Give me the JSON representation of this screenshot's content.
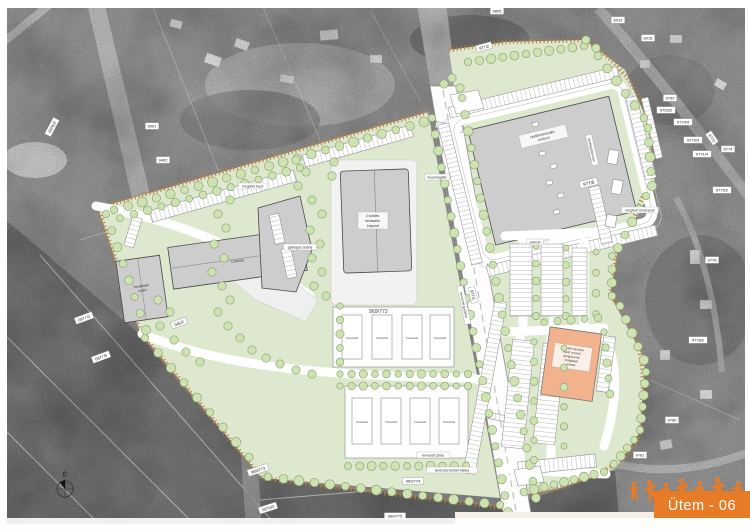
{
  "colors": {
    "brand_orange": "#e87c26",
    "plan_green": "#dde8cf",
    "building_gray": "#cdcdcd",
    "future_orange": "#f2b28e",
    "boundary_tan": "#bf7f3f"
  },
  "banner": {
    "phase_label": "Ütem - 06"
  },
  "compass": {
    "north_label": "É"
  },
  "site": {
    "parcel_main": "969/772",
    "multifunction": {
      "lines": [
        "Multifunkcionális",
        "centrum"
      ],
      "parcel": "977/8"
    },
    "retail": {
      "lines": [
        "2 szintes",
        "bevásárló",
        "központ"
      ]
    },
    "services": {
      "lines": [
        "Szolgáltató",
        "épület"
      ]
    },
    "strip_building": {
      "label": "Üzletsor"
    },
    "future": {
      "lines": [
        "Második ütemben",
        "épülő rendelő,",
        "gyógyszertár,",
        "szolgáltató",
        "üzletek"
      ]
    },
    "rowhouse_label": "Társasház"
  },
  "parcel_labels": [
    {
      "t": "6001",
      "x": 152,
      "y": 126,
      "r": 0
    },
    {
      "t": "9402",
      "x": 163,
      "y": 160,
      "r": 0
    },
    {
      "t": "0976/2",
      "x": 52,
      "y": 127,
      "r": -62
    },
    {
      "t": "0977/2",
      "x": 84,
      "y": 318,
      "r": -20
    },
    {
      "t": "0977/5",
      "x": 101,
      "y": 357,
      "r": -20
    },
    {
      "t": "049/2",
      "x": 179,
      "y": 323,
      "r": -20
    },
    {
      "t": "969/773",
      "x": 258,
      "y": 470,
      "r": -18
    },
    {
      "t": "0979/3",
      "x": 268,
      "y": 508,
      "r": -18
    },
    {
      "t": "969/774",
      "x": 413,
      "y": 481,
      "r": 0
    },
    {
      "t": "969/775",
      "x": 395,
      "y": 516,
      "r": 0
    },
    {
      "t": "9805",
      "x": 497,
      "y": 11,
      "r": 0
    },
    {
      "t": "977/2",
      "x": 484,
      "y": 47,
      "r": -15
    },
    {
      "t": "977/1",
      "x": 473,
      "y": 295,
      "r": 76
    },
    {
      "t": "9762",
      "x": 670,
      "y": 98,
      "r": 0
    },
    {
      "t": "9763/2",
      "x": 666,
      "y": 110,
      "r": 0
    },
    {
      "t": "9770/4",
      "x": 683,
      "y": 122,
      "r": 0
    },
    {
      "t": "9770/3",
      "x": 693,
      "y": 140,
      "r": 0
    },
    {
      "t": "9771/4",
      "x": 702,
      "y": 154,
      "r": 0
    },
    {
      "t": "9774",
      "x": 728,
      "y": 149,
      "r": 0
    },
    {
      "t": "9775/2",
      "x": 722,
      "y": 190,
      "r": 0
    },
    {
      "t": "9772",
      "x": 712,
      "y": 138,
      "r": 55
    },
    {
      "t": "9776",
      "x": 712,
      "y": 260,
      "r": 0
    },
    {
      "t": "9778/2",
      "x": 698,
      "y": 340,
      "r": 0
    },
    {
      "t": "9780",
      "x": 672,
      "y": 420,
      "r": 0
    },
    {
      "t": "9781",
      "x": 640,
      "y": 455,
      "r": 0
    },
    {
      "t": "6012",
      "x": 618,
      "y": 20,
      "r": 0
    },
    {
      "t": "6015",
      "x": 648,
      "y": 38,
      "r": 0
    }
  ],
  "annotations": [
    {
      "t": "meglévő fasor",
      "x": 253,
      "y": 186,
      "r": 0
    },
    {
      "t": "buszmegálló",
      "x": 437,
      "y": 177,
      "r": 0
    },
    {
      "t": "gyalogos sétány",
      "x": 300,
      "y": 247,
      "r": 0
    },
    {
      "t": "tervezett gyűjtőút",
      "x": 464,
      "y": 305,
      "r": 78
    },
    {
      "t": "parkoló",
      "x": 535,
      "y": 242,
      "r": 0
    },
    {
      "t": "kerékpártámasz",
      "x": 592,
      "y": 150,
      "r": 77
    },
    {
      "t": "meglévő növényzet",
      "x": 640,
      "y": 210,
      "r": 0
    },
    {
      "t": "tervezési terület határa",
      "x": 452,
      "y": 470,
      "r": 0
    },
    {
      "t": "tervezett járda",
      "x": 433,
      "y": 455,
      "r": 0
    }
  ]
}
